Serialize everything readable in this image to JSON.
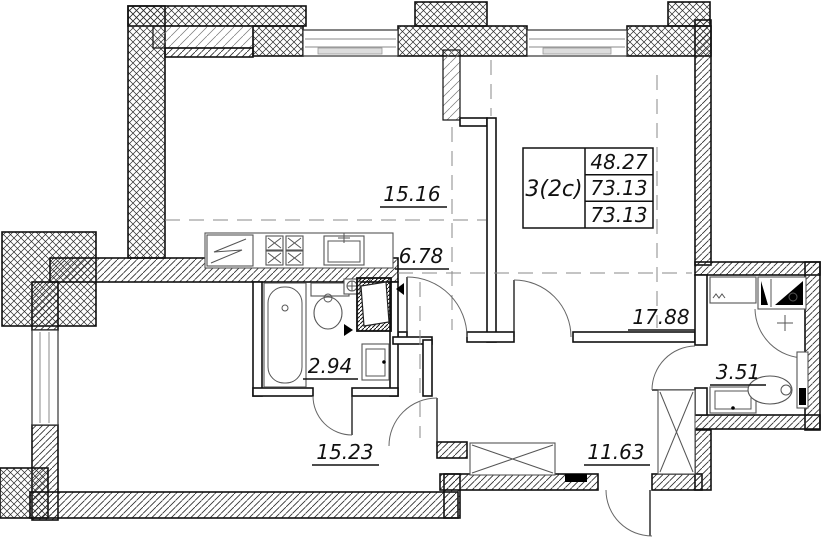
{
  "plan": {
    "title_block": {
      "unit_label": "3(2c)",
      "rows": [
        "48.27",
        "73.13",
        "73.13"
      ]
    },
    "rooms": {
      "kitchen_living": {
        "area": "15.16"
      },
      "kitchen_zone": {
        "area": "6.78"
      },
      "bedroom": {
        "area": "17.88"
      },
      "bathroom": {
        "area": "2.94"
      },
      "shower_room": {
        "area": "3.51"
      },
      "living_room": {
        "area": "15.23"
      },
      "hallway": {
        "area": "11.63"
      }
    },
    "colors": {
      "line": "#1a1a1a",
      "background": "#ffffff"
    }
  }
}
